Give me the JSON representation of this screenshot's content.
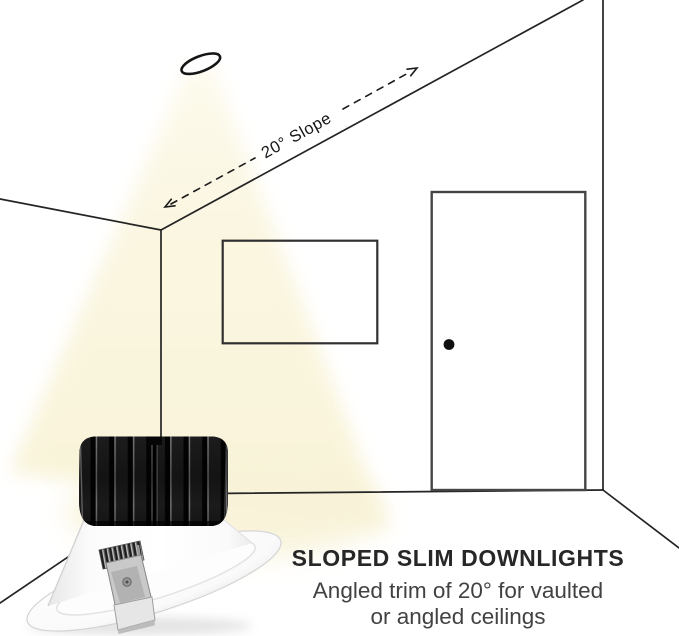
{
  "infographic": {
    "slope_annotation": "20° Slope",
    "caption": {
      "title": "SLOPED SLIM DOWNLIGHTS",
      "line1": "Angled trim of 20° for vaulted",
      "line2": "or angled ceilings"
    },
    "colors": {
      "beam_light": "#f8f3d8",
      "line_art": "#242424",
      "door_outline": "#454545",
      "caption_title": "#272727",
      "caption_body": "#424242"
    }
  }
}
